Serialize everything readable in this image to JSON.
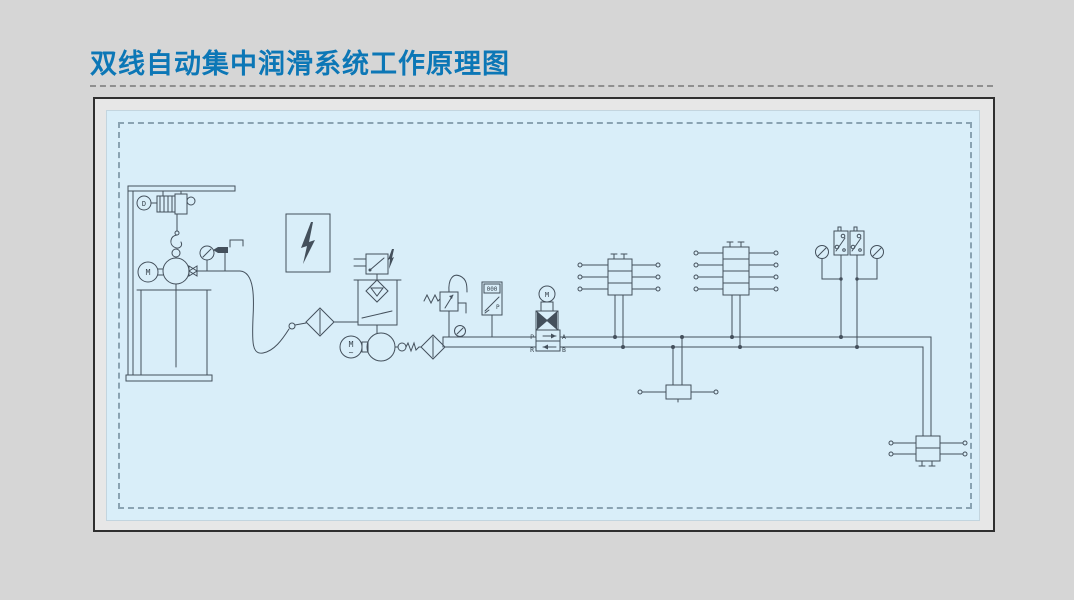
{
  "page": {
    "title": "双线自动集中润滑系统工作原理图",
    "background": "#d6d6d6",
    "accent_color": "#0c77b6",
    "panel_background": "#d9eef9",
    "line_color": "#44505c"
  },
  "diagram": {
    "labels": {
      "hoist_motor": "D",
      "barrel_pump_motor": "M",
      "main_pump_motor": "M",
      "main_pump_phase": "~",
      "valve_motor": "M",
      "pressure_display": "000",
      "pressure_display_pointer": "P",
      "valve_port_p": "P",
      "valve_port_a": "A",
      "valve_port_r": "R",
      "valve_port_b": "B"
    }
  }
}
